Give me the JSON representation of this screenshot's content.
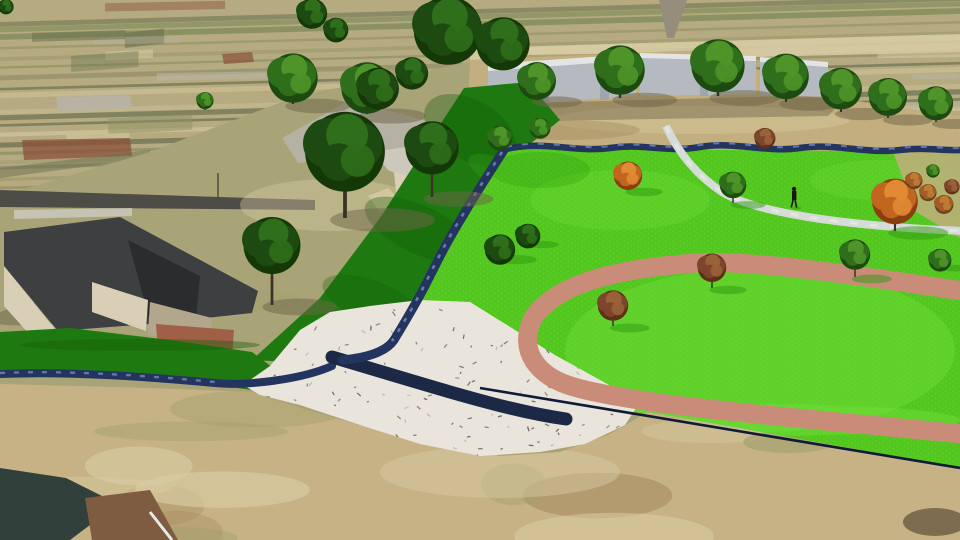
{
  "scene": {
    "title": "3D aerial rendering of a park and creek drainage improvement",
    "description": "Computer-generated aerial view: a blue creek flows from distant tan farm fields through a dark-green grass corridor into a white rock riprap spillway with a dark low-flow channel that drains to the east. A pink walking loop curves through bright green lawn dotted with green and autumn-orange trees; a pedestrian walks on a light gray path. Houses with dark roofs, a street and long gray buildings line the left and the horizon.",
    "elements": [
      "distant-fields",
      "vertical-road",
      "street",
      "sidewalk",
      "warehouse-buildings",
      "tree-row",
      "creek",
      "grass-corridor",
      "riprap-spillway",
      "low-flow-channel",
      "drainage-line",
      "lawn",
      "walking-loop-track",
      "gravel-path",
      "pedestrian",
      "house-dark-roof",
      "house-gray-roof",
      "corner-building",
      "dirt-field"
    ],
    "pedestrian_label": "person walking on path",
    "tree_count": 37
  },
  "palette": {
    "base_ground": "#a9a478",
    "fields_base": "#b6ab80",
    "stripe_olive": "#8e9164",
    "stripe_light": "#d8cca3",
    "stripe_dark": "#6a7050",
    "stripe_green": "#7c8a58",
    "patch_red": "#8b5038",
    "patch_gray": "#b7b3a4",
    "road_vertical": "#968d7c",
    "road_dark": "#4e4c46",
    "sidewalk": "#c6c2b4",
    "pole": "#4a463c",
    "building_wall": "#b4bac0",
    "building_top": "#e3e5e5",
    "building_door": "#98a2aa",
    "building_shadow": "#6e6448",
    "dirt_strip": "#c2ae7e",
    "dirt_bottom": "#c6b285",
    "dirt_light": "#dacda3",
    "dirt_olive": "#a3a06d",
    "dirt_brown": "#a78c60",
    "dirt_dark": "#6b5a40",
    "lawn": "#53c61f",
    "lawn_light": "#6fdd37",
    "lawn_dark": "#2e9a12",
    "bank_green": "#1e7a10",
    "bank_dark": "#145c08",
    "bank_bright": "#2f9a1a",
    "creek_dark": "#23345f",
    "creek_light": "#7089b8",
    "riprap": "#eae5dc",
    "riprap_speck": "#6f675a",
    "riprap_speck_light": "#b9b0a0",
    "channel": "#1b2947",
    "drain_line": "#101c36",
    "track_pink": "#c98c79",
    "path_gray": "#d5dbd7",
    "path_light": "#eceee8",
    "tree_darkest": "#143808",
    "tree_dark": "#1d4a10",
    "tree_mid": "#2f6e1a",
    "tree_light": "#4f9428",
    "trunk": "#3a3226",
    "shadow_ground": "#6e6448",
    "orange_dark": "#8a3f10",
    "orange_mid": "#c2661f",
    "orange_light": "#e08a33",
    "red_dark": "#5e3018",
    "red_mid": "#7c452c",
    "red_light": "#9a6038",
    "autumn_dark": "#6b431f",
    "autumn_mid": "#a35c28",
    "autumn_light": "#c07b33",
    "house1_roof": "#3e3f41",
    "house1_roof_dark": "#2b2c2e",
    "house_wall": "#d8cfb6",
    "house_wall_shadow": "#b2a78c",
    "house2_roof": "#b5b1a3",
    "house2_roof_light": "#ccc9bc",
    "corner_roof_dark": "#31403a",
    "corner_roof_brown": "#7e5c41",
    "ridge_white": "#e9e9e3",
    "patio_red": "#a06048",
    "person": "#161616"
  }
}
